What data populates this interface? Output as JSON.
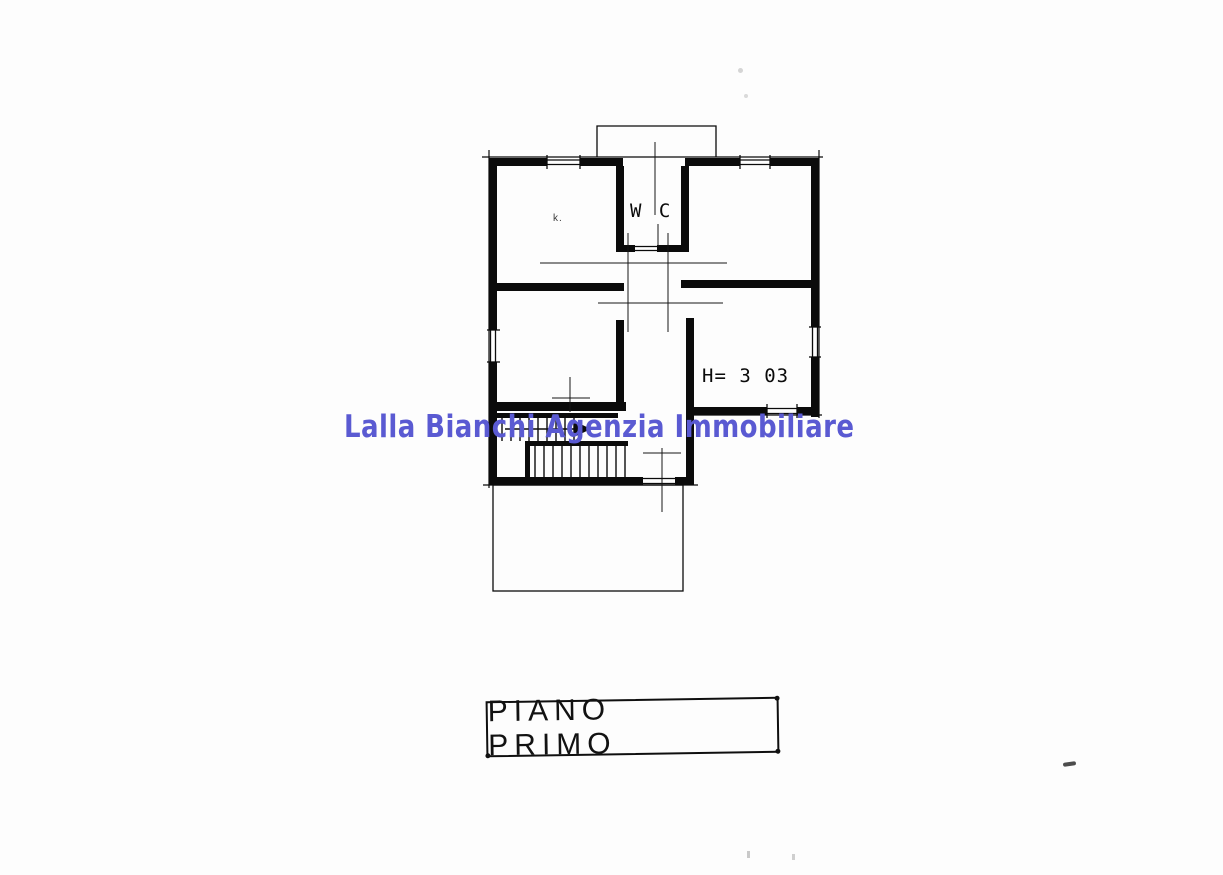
{
  "document": {
    "kind": "scanned floor plan",
    "background": "#fdfdfd",
    "line_color": "#0b0b0b"
  },
  "watermark": {
    "text": "Lalla Bianchi Agenzia Immobiliare",
    "color": "#5a5ad2"
  },
  "plan": {
    "labels": {
      "wc": "W C",
      "room_height": "H= 3 03",
      "artifact_mark": "k."
    }
  },
  "title_block": {
    "text": "PIANO PRIMO"
  }
}
